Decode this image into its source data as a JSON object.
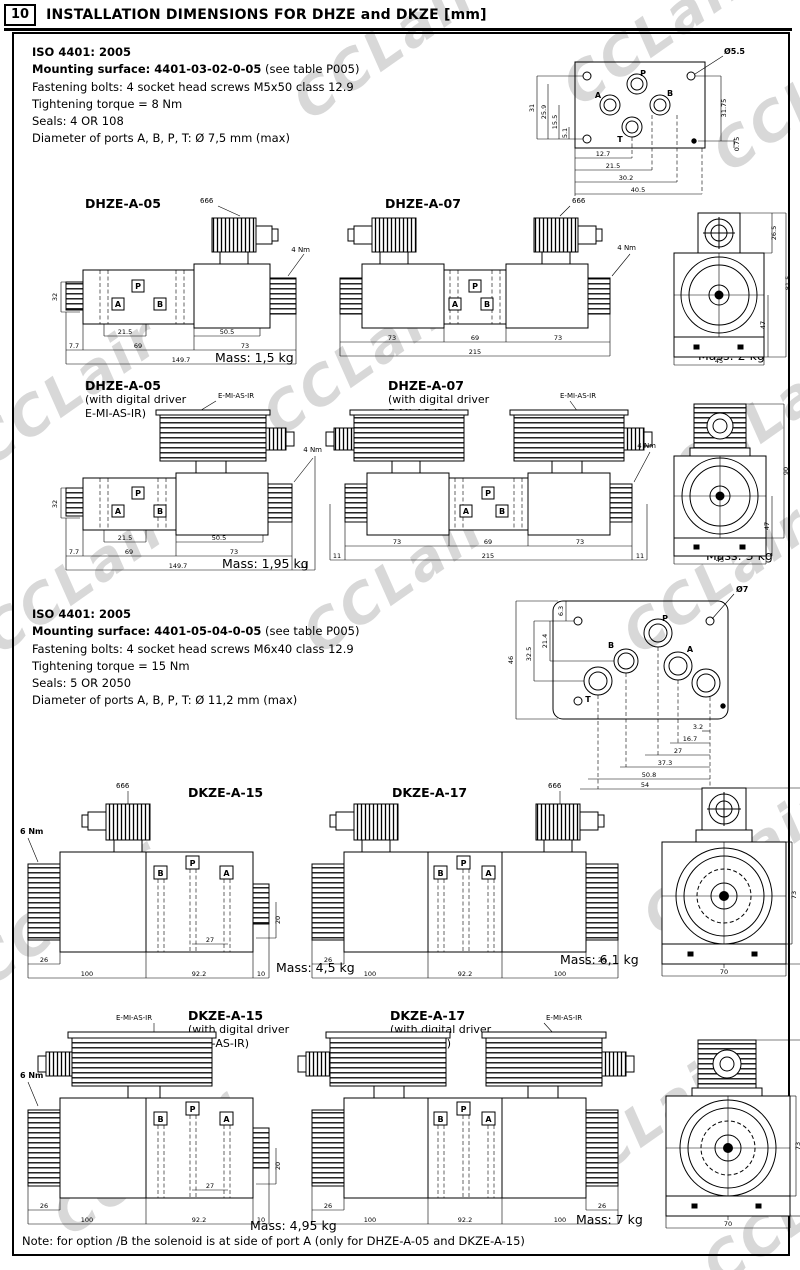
{
  "page": {
    "section_number": "10",
    "title": "INSTALLATION DIMENSIONS FOR DHZE and DKZE [mm]",
    "note": "Note: for option /B the solenoid is at side of port A (only for DHZE-A-05 and DKZE-A-15)",
    "watermark": "CCLair"
  },
  "spec1": {
    "iso": "ISO 4401: 2005",
    "mounting_bold": "Mounting surface: 4401-03-02-0-05",
    "mounting_rest": " (see table P005)",
    "bolts": "Fastening bolts: 4 socket head screws M5x50 class 12.9",
    "torque": "Tightening torque = 8 Nm",
    "seals": "Seals: 4 OR 108",
    "ports": "Diameter of ports A, B, P, T:  Ø 7,5 mm (max)"
  },
  "spec2": {
    "iso": "ISO 4401: 2005",
    "mounting_bold": "Mounting surface: 4401-05-04-0-05",
    "mounting_rest": " (see table P005)",
    "bolts": "Fastening bolts: 4 socket head screws M6x40 class 12.9",
    "torque": "Tightening torque = 15 Nm",
    "seals": "Seals: 5 OR 2050",
    "ports": "Diameter of ports A, B, P, T:  Ø 11,2 mm (max)"
  },
  "labels": {
    "connector": "666",
    "driver": "E-MI-AS-IR",
    "torque4": "4 Nm",
    "torque6": "6 Nm",
    "with_driver_1": "(with digital driver",
    "with_driver_2": "E-MI-AS-IR)"
  },
  "ports": {
    "a": "A",
    "b": "B",
    "p": "P",
    "t": "T"
  },
  "models": {
    "dhze05": "DHZE-A-05",
    "dhze07": "DHZE-A-07",
    "dkze15": "DKZE-A-15",
    "dkze17": "DKZE-A-17"
  },
  "mass": {
    "dhze05": "Mass: 1,5 kg",
    "dhze07": "Mass: 2 kg",
    "dhze05d": "Mass: 1,95 kg",
    "dhze07d": "Mass: 3 kg",
    "dkze15": "Mass: 4,5 kg",
    "dkze17": "Mass: 6,1 kg",
    "dkze15d": "Mass: 4,95 kg",
    "dkze17d": "Mass: 7 kg"
  },
  "dims": {
    "surface1": {
      "hole": "Ø5.5",
      "left": [
        "31",
        "25.9",
        "15.5",
        "5.1"
      ],
      "right": [
        "31.75",
        "0.75"
      ],
      "bottom": [
        "12.7",
        "21.5",
        "30.2",
        "40.5"
      ]
    },
    "surface2": {
      "hole": "Ø7",
      "left": [
        "6.3",
        "21.4",
        "32.5",
        "46"
      ],
      "bottom": [
        "3.2",
        "16.7",
        "27",
        "37.3",
        "50.8",
        "54"
      ]
    },
    "dhze05": [
      "32",
      "21.5",
      "50.5",
      "7.7",
      "69",
      "73",
      "149.7"
    ],
    "dhze07": [
      "73",
      "69",
      "73",
      "215"
    ],
    "end1": [
      "26.5",
      "81.5",
      "47",
      "45"
    ],
    "dhze05d": [
      "32",
      "21.5",
      "50.5",
      "7.7",
      "69",
      "73",
      "149.7",
      "11"
    ],
    "dhze07d": [
      "73",
      "69",
      "73",
      "11",
      "215",
      "11"
    ],
    "end2": [
      "90",
      "47",
      "45"
    ],
    "dkze15": [
      "26",
      "100",
      "92.2",
      "10",
      "27",
      "20"
    ],
    "dkze17": [
      "26",
      "100",
      "92.2",
      "100",
      "26"
    ],
    "end3": [
      "105.5",
      "73",
      "70"
    ],
    "end4": [
      "114",
      "73",
      "70"
    ]
  }
}
